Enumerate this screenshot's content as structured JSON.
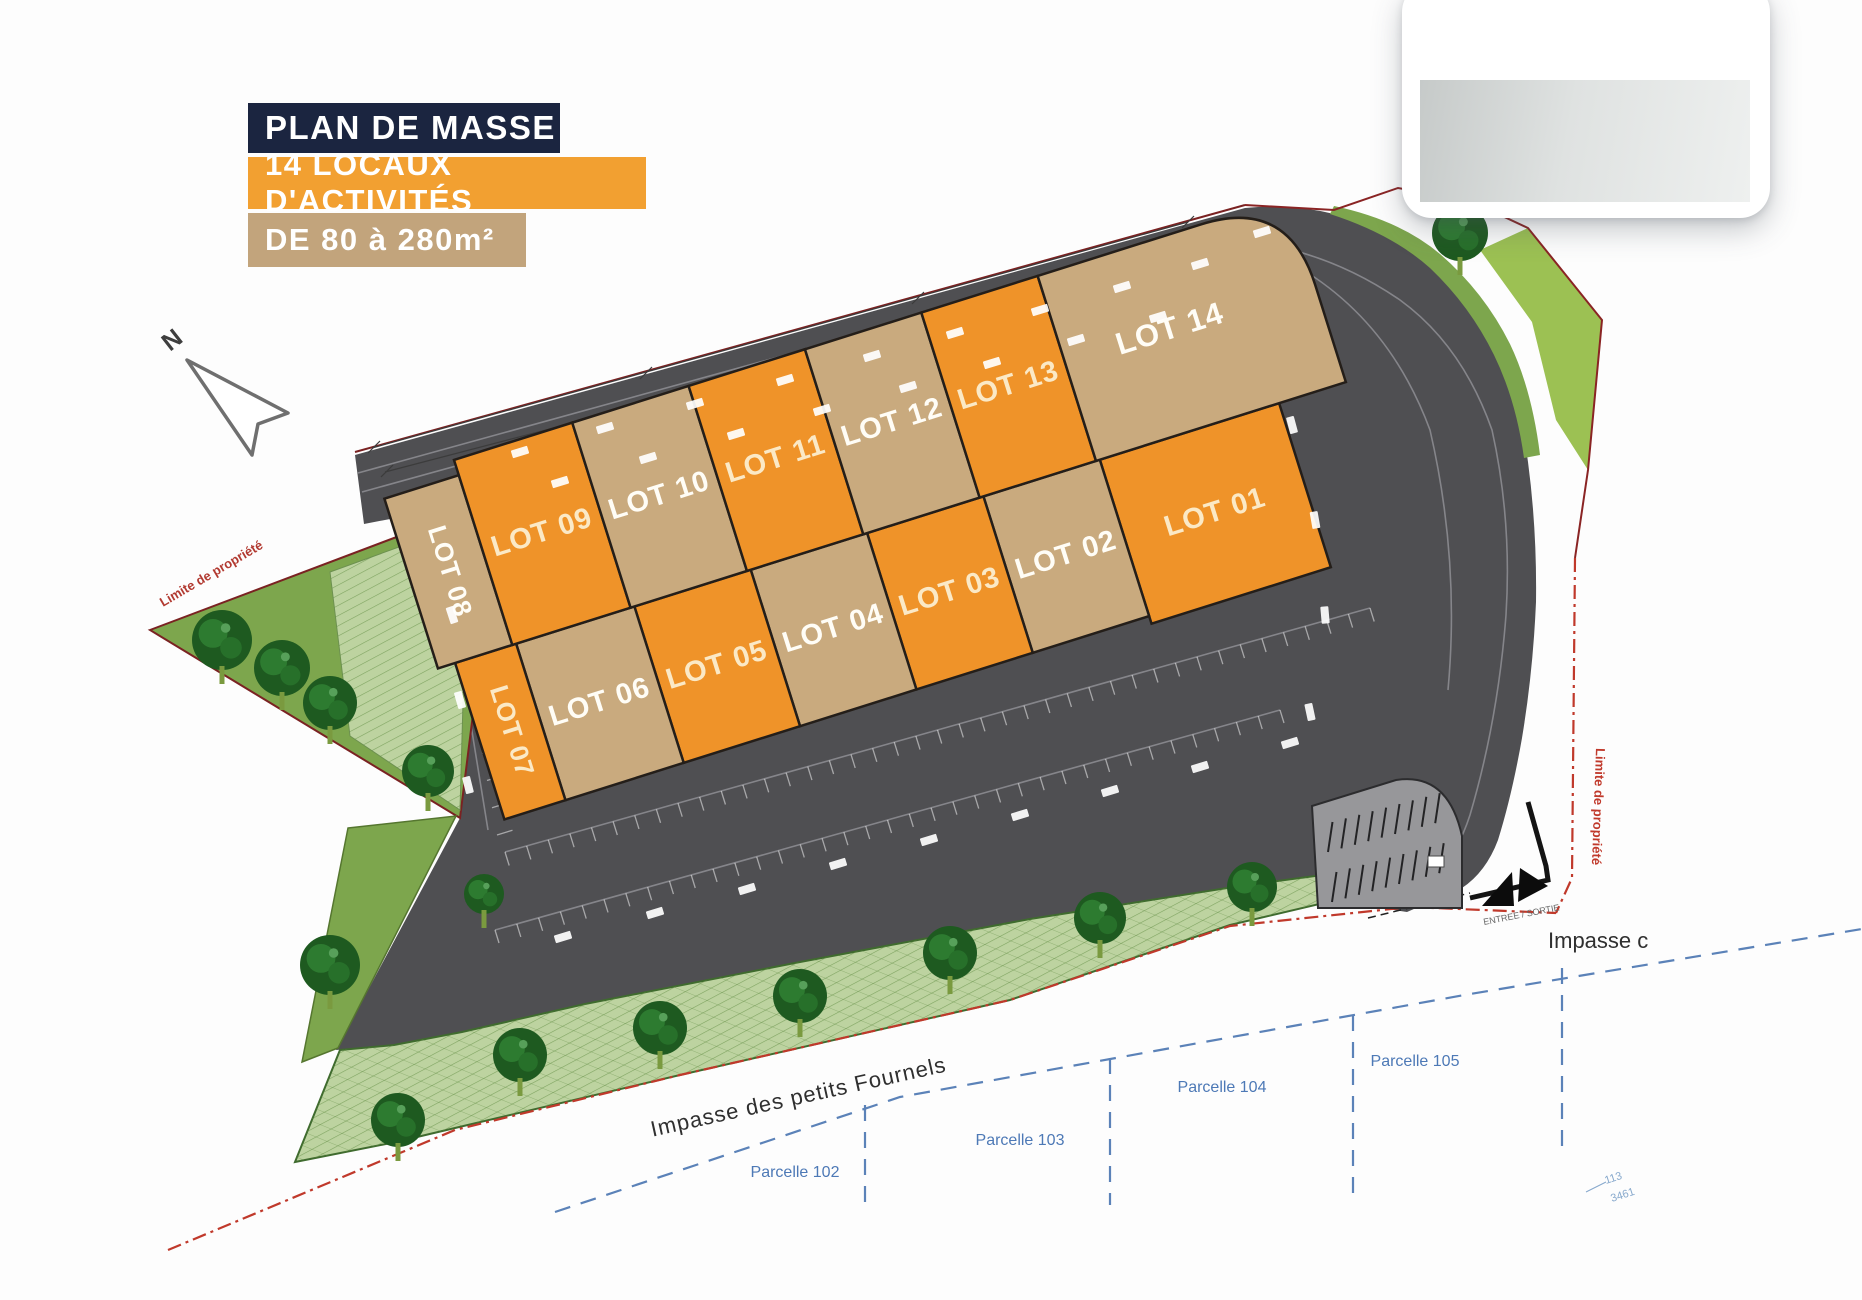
{
  "title_block": {
    "line1": "PLAN DE MASSE",
    "line2": "14 LOCAUX D'ACTIVITÉS",
    "line3": "DE 80 à 280m²"
  },
  "north_label": "N",
  "lots": [
    {
      "id": "01",
      "label": "LOT 01",
      "color": "orange"
    },
    {
      "id": "02",
      "label": "LOT 02",
      "color": "tan"
    },
    {
      "id": "03",
      "label": "LOT 03",
      "color": "orange"
    },
    {
      "id": "04",
      "label": "LOT 04",
      "color": "tan"
    },
    {
      "id": "05",
      "label": "LOT 05",
      "color": "orange"
    },
    {
      "id": "06",
      "label": "LOT 06",
      "color": "tan"
    },
    {
      "id": "07",
      "label": "LOT 07",
      "color": "orange"
    },
    {
      "id": "08",
      "label": "LOT 08",
      "color": "tan"
    },
    {
      "id": "09",
      "label": "LOT 09",
      "color": "orange"
    },
    {
      "id": "10",
      "label": "LOT 10",
      "color": "tan"
    },
    {
      "id": "11",
      "label": "LOT 11",
      "color": "orange"
    },
    {
      "id": "12",
      "label": "LOT 12",
      "color": "tan"
    },
    {
      "id": "13",
      "label": "LOT 13",
      "color": "orange"
    },
    {
      "id": "14",
      "label": "LOT 14",
      "color": "tan"
    }
  ],
  "annotations": {
    "limite_left": "Limite de propriété",
    "limite_right": "Limite de propriété",
    "street_main": "Impasse des petits Fournels",
    "street_right": "Impasse c",
    "entrance": "ENTREE / SORTIE",
    "cadastre_1": "113",
    "cadastre_2": "3461"
  },
  "parcels": [
    {
      "label": "Parcelle 102"
    },
    {
      "label": "Parcelle 103"
    },
    {
      "label": "Parcelle 104"
    },
    {
      "label": "Parcelle 105"
    }
  ],
  "colors": {
    "navy": "#1b2540",
    "banner_orange": "#f2a031",
    "banner_tan": "#c2a47c",
    "lot_orange": "#ef9329",
    "lot_tan": "#c9aa7e",
    "road": "#4f4f52",
    "parking_light": "#97979a",
    "grass": "#7da64d",
    "grass_bright": "#9cc153",
    "grass_hatch": "#bdd3a0",
    "tree": "#1e5a20",
    "boundary_red": "#c0392b",
    "parcel_blue": "#5b82b8",
    "label_cream": "#fbeed6"
  }
}
